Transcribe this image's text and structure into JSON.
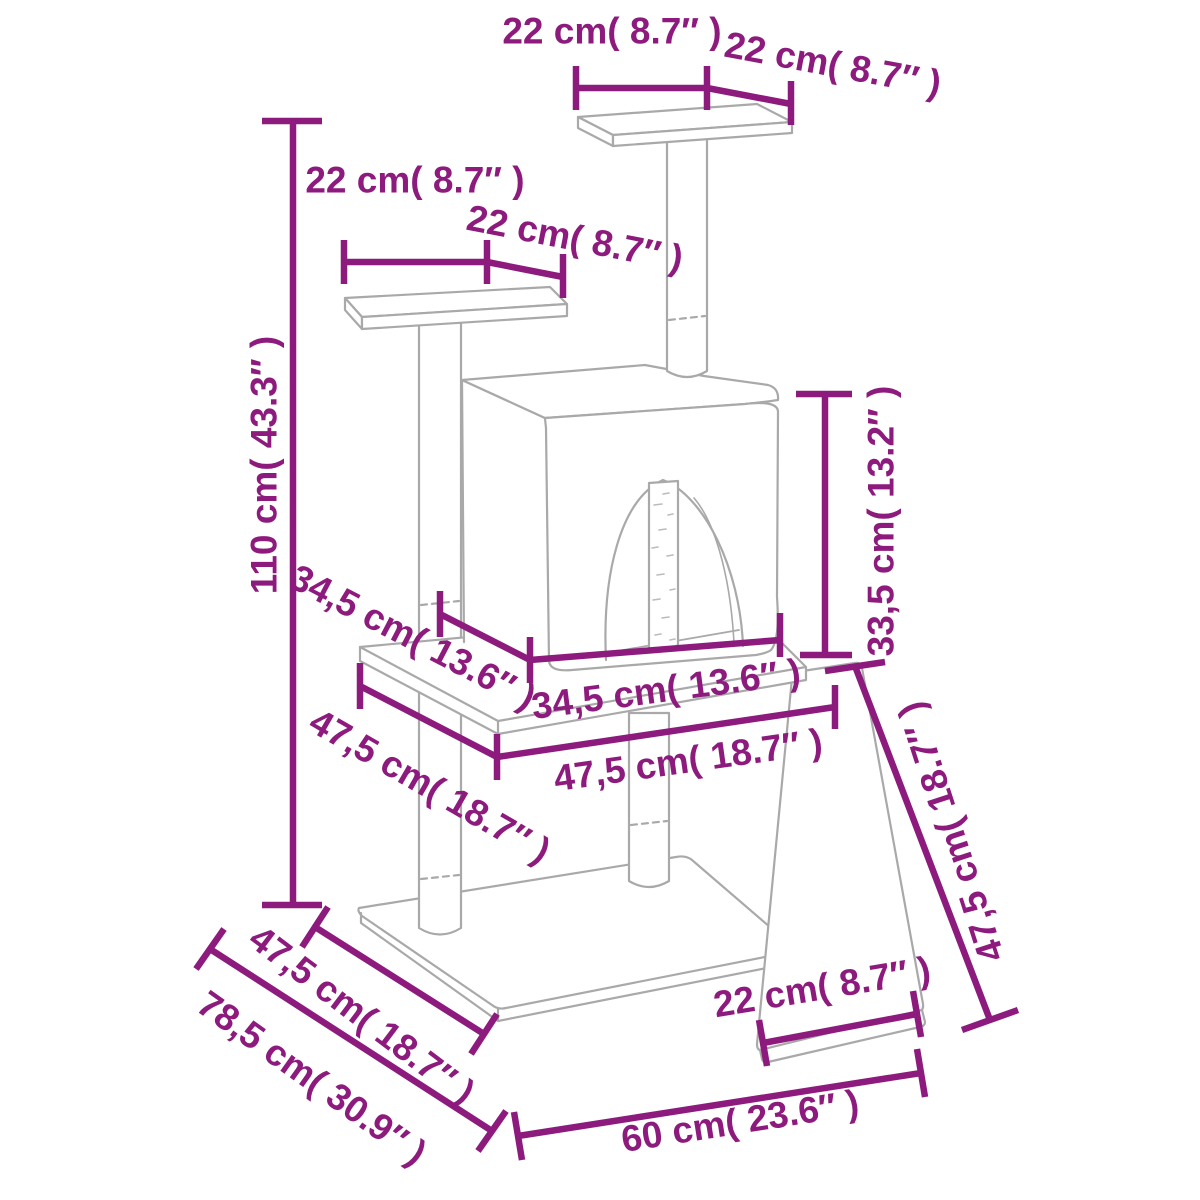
{
  "diagram": {
    "type": "product-dimension-diagram",
    "subject": "cat tree with scratching posts, condo, platforms and ramp",
    "unit_format": "cm ( inches )",
    "colors": {
      "accent": "#8d1b7e",
      "line_art": "#a9a9a9",
      "background": "#ffffff"
    },
    "labels": [
      {
        "id": "top-platform-width",
        "text": "22 cm( 8.7″ )",
        "x": 612,
        "y": 31,
        "rotation": 0
      },
      {
        "id": "top-platform-depth",
        "text": "22 cm( 8.7″ )",
        "x": 833,
        "y": 64,
        "rotation": 10.5
      },
      {
        "id": "left-platform-width",
        "text": "22 cm( 8.7″ )",
        "x": 415,
        "y": 180,
        "rotation": 0
      },
      {
        "id": "left-platform-depth",
        "text": "22 cm( 8.7″ )",
        "x": 575,
        "y": 238,
        "rotation": 11
      },
      {
        "id": "total-height",
        "text": "110 cm( 43.3″ )",
        "x": 264,
        "y": 465,
        "rotation": -90
      },
      {
        "id": "condo-height",
        "text": "33,5 cm( 13.2″ )",
        "x": 881,
        "y": 521,
        "rotation": -90
      },
      {
        "id": "condo-depth",
        "text": "34,5 cm( 13.6″ )",
        "x": 413,
        "y": 637,
        "rotation": 27.5
      },
      {
        "id": "condo-width",
        "text": "34,5 cm( 13.6″ )",
        "x": 666,
        "y": 689,
        "rotation": -7.5
      },
      {
        "id": "middle-board-depth",
        "text": "47,5 cm( 18.7″ )",
        "x": 430,
        "y": 786,
        "rotation": 30
      },
      {
        "id": "middle-board-width",
        "text": "47,5 cm( 18.7″ )",
        "x": 688,
        "y": 760,
        "rotation": -8
      },
      {
        "id": "ramp-length",
        "text": "47,5 cm( 18.7″ )",
        "x": 951,
        "y": 832,
        "rotation": -108
      },
      {
        "id": "base-board-depth",
        "text": "47,5 cm( 18.7″ )",
        "x": 362,
        "y": 1015,
        "rotation": 37
      },
      {
        "id": "footprint-depth",
        "text": "78,5 cm( 30.9″ )",
        "x": 312,
        "y": 1078,
        "rotation": 35.5
      },
      {
        "id": "ramp-width",
        "text": "22 cm( 8.7″ )",
        "x": 822,
        "y": 987,
        "rotation": -9.5
      },
      {
        "id": "base-width",
        "text": "60 cm( 23.6″ )",
        "x": 740,
        "y": 1121,
        "rotation": -9
      }
    ],
    "measurements": {
      "total_height": "110 cm( 43.3″ )",
      "base_width": "60 cm( 23.6″ )",
      "footprint_depth": "78,5 cm( 30.9″ )",
      "base_board_depth": "47,5 cm( 18.7″ )",
      "middle_board": "47,5 cm( 18.7″ ) × 47,5 cm( 18.7″ )",
      "condo": "34,5 cm( 13.6″ ) × 34,5 cm( 13.6″ ) × 33,5 cm( 13.2″ )",
      "platforms": "22 cm( 8.7″ ) × 22 cm( 8.7″ )",
      "ramp": "47,5 cm( 18.7″ ) × 22 cm( 8.7″ )"
    }
  }
}
